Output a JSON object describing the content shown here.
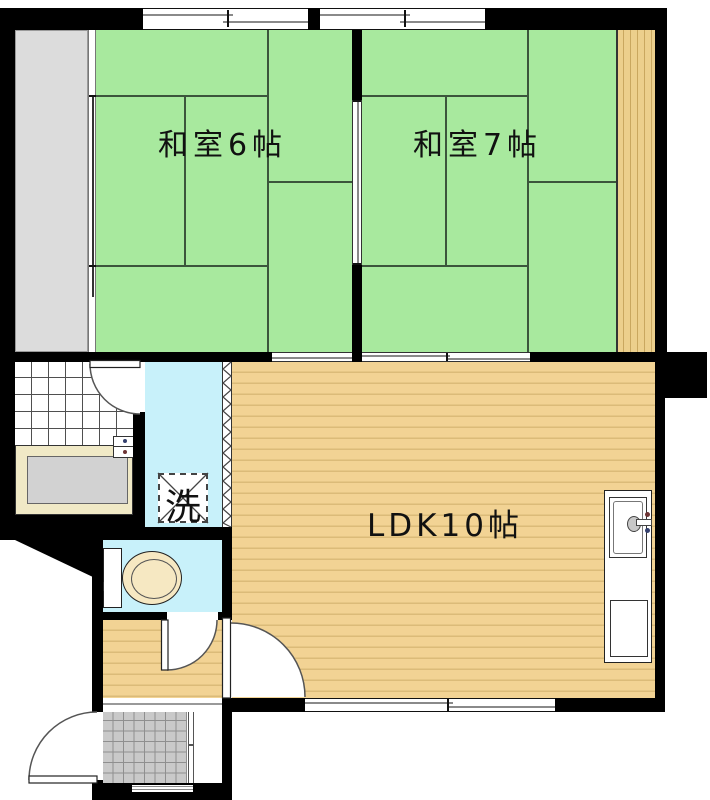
{
  "plan": {
    "type": "apartment-floor-plan",
    "rooms": {
      "washitsu6": {
        "label": "和室6帖"
      },
      "washitsu7": {
        "label": "和室7帖"
      },
      "ldk": {
        "label": "LDK10帖"
      },
      "laundry": {
        "label": "洗"
      }
    },
    "colors": {
      "tatami_green": "#a8e99e",
      "wood_floor_tan": "#f2d394",
      "wood_stripe": "#dbbb79",
      "water_blue": "#c8f1fa",
      "balcony_gray": "#dcdcdc",
      "wall_black": "#000000",
      "bathtub_gray": "#d2d2d2",
      "bathtub_rim_cream": "#f0e9c6",
      "toilet_seat_cream": "#f6e8c2",
      "entry_tile_gray": "#c9c9c9"
    }
  }
}
